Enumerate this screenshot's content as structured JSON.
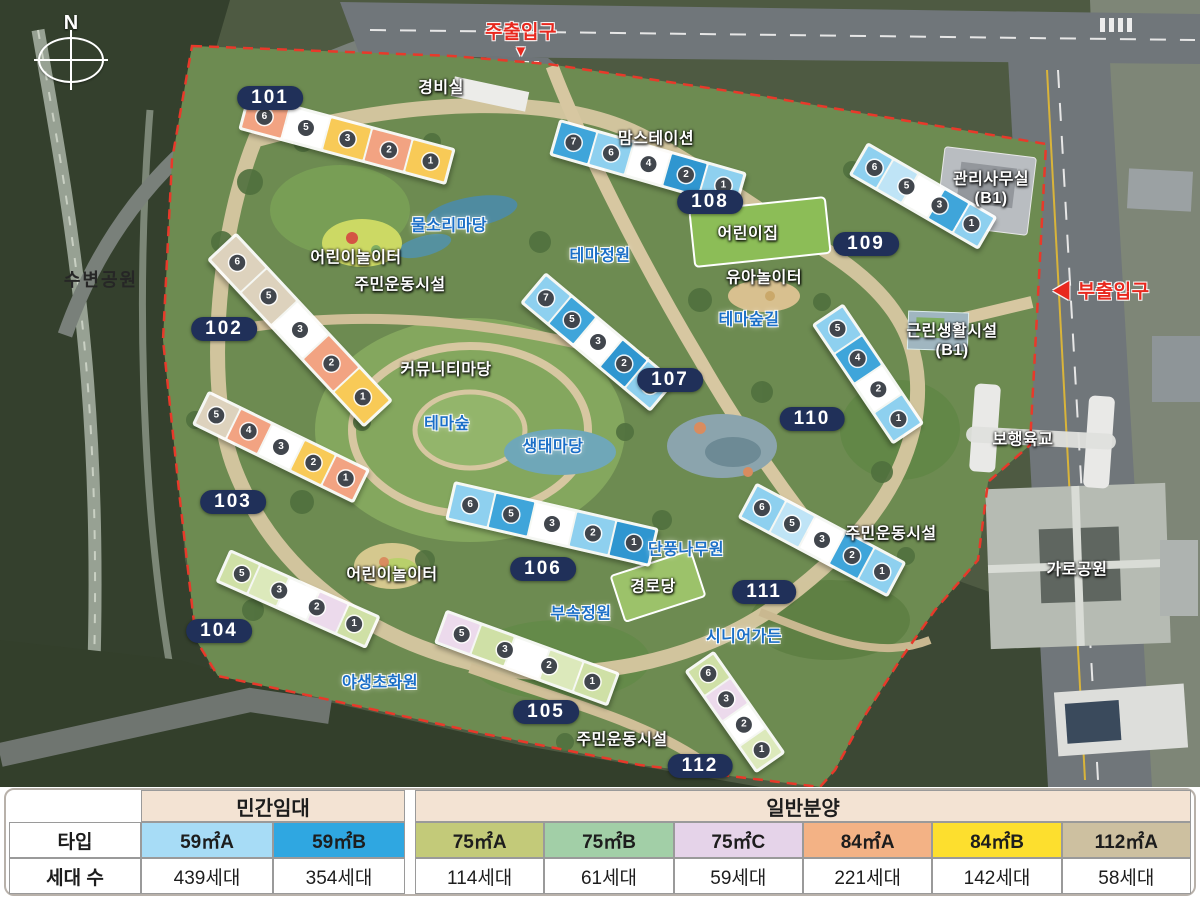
{
  "map": {
    "compass_label": "N",
    "colors": {
      "badge_bg": "#203059",
      "boundary_red": "#e8392a",
      "label_blue": "#1b6fc7",
      "label_red": "#e8281e"
    },
    "badges": [
      {
        "num": "101",
        "x": 270,
        "y": 98
      },
      {
        "num": "102",
        "x": 224,
        "y": 329
      },
      {
        "num": "103",
        "x": 233,
        "y": 502
      },
      {
        "num": "104",
        "x": 219,
        "y": 631
      },
      {
        "num": "105",
        "x": 546,
        "y": 712
      },
      {
        "num": "106",
        "x": 543,
        "y": 569
      },
      {
        "num": "107",
        "x": 670,
        "y": 380
      },
      {
        "num": "108",
        "x": 710,
        "y": 202
      },
      {
        "num": "109",
        "x": 866,
        "y": 244
      },
      {
        "num": "110",
        "x": 812,
        "y": 419
      },
      {
        "num": "111",
        "x": 764,
        "y": 592
      },
      {
        "num": "112",
        "x": 700,
        "y": 766
      }
    ],
    "labels": [
      {
        "name": "main-entrance",
        "kind": "red",
        "x": 521,
        "y": 40,
        "lines": [
          "주출입구",
          "▼"
        ]
      },
      {
        "name": "guard-office",
        "kind": "white",
        "x": 441,
        "y": 88,
        "text": "경비실"
      },
      {
        "name": "mom-station",
        "kind": "white",
        "x": 656,
        "y": 139,
        "text": "맘스테이션"
      },
      {
        "name": "management-office",
        "kind": "white",
        "x": 991,
        "y": 189,
        "lines": [
          "관리사무실",
          "(B1)"
        ]
      },
      {
        "name": "water-sound-yard",
        "kind": "blue",
        "x": 449,
        "y": 226,
        "text": "물소리마당"
      },
      {
        "name": "children-playground-north",
        "kind": "white",
        "x": 356,
        "y": 258,
        "text": "어린이놀이터"
      },
      {
        "name": "residents-sports-north",
        "kind": "white",
        "x": 400,
        "y": 285,
        "text": "주민운동시설"
      },
      {
        "name": "waterside-park",
        "kind": "dark",
        "x": 101,
        "y": 281,
        "text": "수변공원"
      },
      {
        "name": "theme-garden",
        "kind": "blue",
        "x": 600,
        "y": 256,
        "text": "테마정원"
      },
      {
        "name": "daycare-center",
        "kind": "white",
        "x": 748,
        "y": 234,
        "text": "어린이집"
      },
      {
        "name": "toddler-playground",
        "kind": "white",
        "x": 764,
        "y": 278,
        "text": "유아놀이터"
      },
      {
        "name": "theme-forest-trail",
        "kind": "blue",
        "x": 749,
        "y": 320,
        "text": "테마숲길"
      },
      {
        "name": "side-entrance",
        "kind": "red",
        "x": 1101,
        "y": 293,
        "text": "◀ 부출입구"
      },
      {
        "name": "neighborhood-facility",
        "kind": "white",
        "x": 952,
        "y": 341,
        "lines": [
          "근린생활시설",
          "(B1)"
        ]
      },
      {
        "name": "community-yard",
        "kind": "white",
        "x": 446,
        "y": 370,
        "text": "커뮤니티마당"
      },
      {
        "name": "theme-forest",
        "kind": "blue",
        "x": 447,
        "y": 424,
        "text": "테마숲"
      },
      {
        "name": "eco-yard",
        "kind": "blue",
        "x": 553,
        "y": 447,
        "text": "생태마당"
      },
      {
        "name": "pedestrian-bridge",
        "kind": "white",
        "x": 1023,
        "y": 440,
        "text": "보행육교"
      },
      {
        "name": "residents-sports-east",
        "kind": "white",
        "x": 891,
        "y": 534,
        "text": "주민운동시설"
      },
      {
        "name": "maple-tree-garden",
        "kind": "blue",
        "x": 686,
        "y": 550,
        "text": "단풍나무원"
      },
      {
        "name": "children-playground-south",
        "kind": "white",
        "x": 392,
        "y": 575,
        "text": "어린이놀이터"
      },
      {
        "name": "street-park",
        "kind": "white",
        "x": 1077,
        "y": 570,
        "text": "가로공원"
      },
      {
        "name": "senior-center",
        "kind": "white",
        "x": 653,
        "y": 587,
        "text": "경로당"
      },
      {
        "name": "annex-garden",
        "kind": "blue",
        "x": 581,
        "y": 614,
        "text": "부속정원"
      },
      {
        "name": "senior-garden",
        "kind": "blue",
        "x": 744,
        "y": 637,
        "text": "시니어가든"
      },
      {
        "name": "wildflower-garden",
        "kind": "blue",
        "x": 380,
        "y": 683,
        "text": "야생초화원"
      },
      {
        "name": "residents-sports-south",
        "kind": "white",
        "x": 622,
        "y": 740,
        "text": "주민운동시설"
      }
    ],
    "buildings": [
      {
        "name": "building-101",
        "x": 347,
        "y": 139,
        "w": 215,
        "h": 38,
        "rot": 15,
        "segs": [
          "#f2a382",
          "#ffffff",
          "#f8ca57",
          "#f2a382",
          "#f8ca57"
        ],
        "units": [
          6,
          5,
          3,
          2,
          1
        ]
      },
      {
        "name": "building-102",
        "x": 300,
        "y": 330,
        "w": 230,
        "h": 40,
        "rot": 47,
        "segs": [
          "#ddd2bd",
          "#ddd2bd",
          "#ffffff",
          "#f2a382",
          "#f8ca57"
        ],
        "units": [
          6,
          5,
          3,
          2,
          1
        ]
      },
      {
        "name": "building-103",
        "x": 281,
        "y": 447,
        "w": 180,
        "h": 38,
        "rot": 26,
        "segs": [
          "#ddd2bd",
          "#f2a382",
          "#ffffff",
          "#f8ca57",
          "#f2a382"
        ],
        "units": [
          5,
          4,
          3,
          2,
          1
        ]
      },
      {
        "name": "building-104",
        "x": 298,
        "y": 599,
        "w": 165,
        "h": 36,
        "rot": 24,
        "segs": [
          "#cfe0a6",
          "#dce9bb",
          "#ffffff",
          "#ecdaec",
          "#cfe0a6"
        ],
        "units": [
          5,
          3,
          2,
          1
        ]
      },
      {
        "name": "building-105",
        "x": 527,
        "y": 658,
        "w": 185,
        "h": 36,
        "rot": 20,
        "segs": [
          "#ecdaec",
          "#cfe0a6",
          "#ffffff",
          "#dce9bb",
          "#cfe0a6"
        ],
        "units": [
          5,
          3,
          2,
          1
        ]
      },
      {
        "name": "building-106",
        "x": 552,
        "y": 524,
        "w": 210,
        "h": 40,
        "rot": 13,
        "segs": [
          "#8ed0ef",
          "#3fa5da",
          "#ffffff",
          "#8ed0ef",
          "#2f96d0"
        ],
        "units": [
          6,
          5,
          3,
          2,
          1
        ]
      },
      {
        "name": "building-107",
        "x": 598,
        "y": 342,
        "w": 170,
        "h": 40,
        "rot": 40,
        "segs": [
          "#8ed0ef",
          "#3fa5da",
          "#ffffff",
          "#2f96d0",
          "#8ed0ef"
        ],
        "units": [
          7,
          5,
          3,
          2,
          1
        ]
      },
      {
        "name": "building-108",
        "x": 648,
        "y": 164,
        "w": 195,
        "h": 38,
        "rot": 16,
        "segs": [
          "#3fa5da",
          "#8ed0ef",
          "#ffffff",
          "#2f96d0",
          "#8ed0ef"
        ],
        "units": [
          7,
          6,
          4,
          2,
          1
        ]
      },
      {
        "name": "building-109",
        "x": 923,
        "y": 196,
        "w": 150,
        "h": 38,
        "rot": 30,
        "segs": [
          "#8ed0ef",
          "#bfe4f6",
          "#ffffff",
          "#3fa5da",
          "#8ed0ef"
        ],
        "units": [
          6,
          5,
          3,
          1
        ]
      },
      {
        "name": "building-110",
        "x": 868,
        "y": 374,
        "w": 145,
        "h": 38,
        "rot": 56,
        "segs": [
          "#8ed0ef",
          "#3fa5da",
          "#ffffff",
          "#8ed0ef"
        ],
        "units": [
          5,
          4,
          2,
          1
        ]
      },
      {
        "name": "building-111",
        "x": 822,
        "y": 540,
        "w": 170,
        "h": 40,
        "rot": 28,
        "segs": [
          "#8ed0ef",
          "#bfe4f6",
          "#ffffff",
          "#3fa5da",
          "#8ed0ef"
        ],
        "units": [
          6,
          5,
          3,
          2,
          1
        ]
      },
      {
        "name": "building-112",
        "x": 735,
        "y": 712,
        "w": 125,
        "h": 36,
        "rot": 55,
        "segs": [
          "#cfe0a6",
          "#ecdaec",
          "#ffffff",
          "#dce9bb"
        ],
        "units": [
          6,
          3,
          2,
          1
        ]
      }
    ]
  },
  "table": {
    "row_labels": {
      "type": "타입",
      "count": "세대 수"
    },
    "group_bg": "#f3e3d3",
    "groups": [
      {
        "label": "민간임대",
        "span": 2
      },
      {
        "label": "일반분양",
        "span": 6
      }
    ],
    "columns": [
      {
        "group": 0,
        "type": "59㎡A",
        "color": "#a7dcf6",
        "count": "439세대"
      },
      {
        "group": 0,
        "type": "59㎡B",
        "color": "#2fa7e1",
        "count": "354세대"
      },
      {
        "group": 1,
        "type": "75㎡A",
        "color": "#c3ca79",
        "count": "114세대"
      },
      {
        "group": 1,
        "type": "75㎡B",
        "color": "#a2cfa7",
        "count": "61세대"
      },
      {
        "group": 1,
        "type": "75㎡C",
        "color": "#e5d3e9",
        "count": "59세대"
      },
      {
        "group": 1,
        "type": "84㎡A",
        "color": "#f3b285",
        "count": "221세대"
      },
      {
        "group": 1,
        "type": "84㎡B",
        "color": "#fddf2e",
        "count": "142세대"
      },
      {
        "group": 1,
        "type": "112㎡A",
        "color": "#cdc0a0",
        "count": "58세대"
      }
    ]
  }
}
